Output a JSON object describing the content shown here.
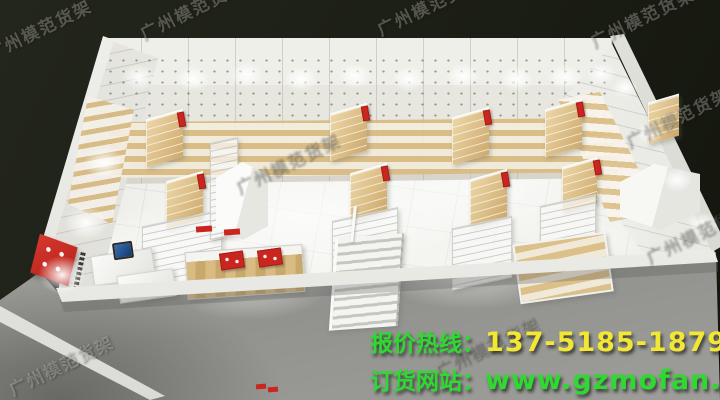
{
  "scene": {
    "type": "3d-retail-store-interior-render",
    "background_color": "#1d2016",
    "floor_color": "#efefeb",
    "outside_floor_color": "#9c9c98",
    "wall_color": "#f3f3ef",
    "wood_shelf_color": "#d9bc83",
    "shelf_sign_red": "#c8261f"
  },
  "watermark": {
    "text": "广州模范货架"
  },
  "promo": {
    "hotline_label": "报价热线：",
    "hotline_number": "137-5185-1879",
    "hotline_label_color": "#2fd932",
    "hotline_number_color": "#f2e732",
    "website_label": "订货网站：",
    "website_url": "www.gzmofan.com",
    "website_color": "#2fd932"
  }
}
